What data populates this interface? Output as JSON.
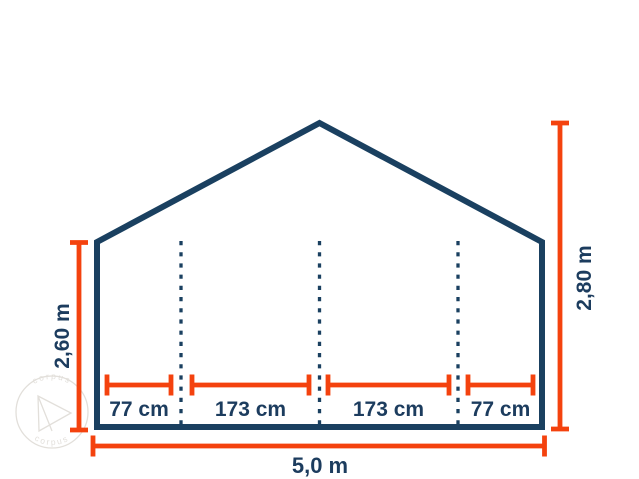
{
  "diagram": {
    "description": "Front cross-section dimension drawing of a gable-roof shelter tent",
    "colors": {
      "background": "#ffffff",
      "structure_outline": "#1a4060",
      "dimension_lines": "#f4420e",
      "label_text": "#1c3c5e",
      "watermark": "#dfdcd7"
    },
    "dimensions": {
      "left_height": {
        "label": "2,60 m",
        "meters": 2.6
      },
      "right_height": {
        "label": "2,80 m",
        "meters": 2.8
      },
      "total_width": {
        "label": "5,0 m",
        "meters": 5.0
      },
      "floor_segments": [
        {
          "label": "77 cm",
          "centimeters": 77
        },
        {
          "label": "173 cm",
          "centimeters": 173
        },
        {
          "label": "173 cm",
          "centimeters": 173
        },
        {
          "label": "77 cm",
          "centimeters": 77
        }
      ]
    },
    "watermark": {
      "text": "corpus"
    }
  }
}
